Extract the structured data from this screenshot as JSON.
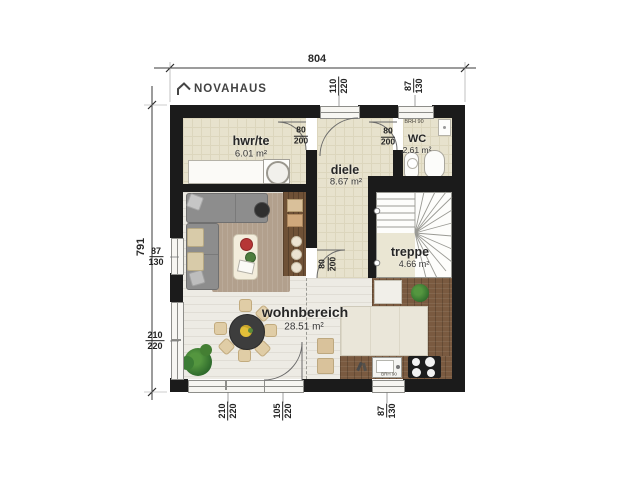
{
  "brand": {
    "name": "NOVAHAUS"
  },
  "dimensions": {
    "total_width": "804",
    "total_height": "791"
  },
  "rooms": {
    "hwrte": {
      "name": "hwr/te",
      "area": "6.01 m²"
    },
    "diele": {
      "name": "diele",
      "area": "8.67 m²"
    },
    "wc": {
      "name": "WC",
      "area": "2.61 m²"
    },
    "treppe": {
      "name": "treppe",
      "area": "4.66 m²"
    },
    "wohnbereich": {
      "name": "wohnbereich",
      "area": "28.51 m²"
    }
  },
  "openings": {
    "entry_door": {
      "w": "110",
      "h": "220"
    },
    "wc_window": {
      "w": "87",
      "h": "130"
    },
    "hwrte_door": {
      "w": "80",
      "h": "200"
    },
    "wc_door": {
      "w": "80",
      "h": "200"
    },
    "wohnbereich_door": {
      "w": "80",
      "h": "200"
    },
    "left_window_upper": {
      "w": "87",
      "h": "130"
    },
    "left_window_lower": {
      "w": "210",
      "h": "220"
    },
    "bottom_window": {
      "w": "210",
      "h": "220"
    },
    "terrace_door": {
      "w": "105",
      "h": "220"
    },
    "kitchen_window": {
      "w": "87",
      "h": "130"
    }
  },
  "annotations": {
    "wc_parapet": "BRH 90",
    "kitchen_parapet": "BRH 90"
  },
  "colors": {
    "wall": "#1b1b1b",
    "tile_floor": "#e7e2cd",
    "wood_floor": "#edebe4",
    "kitchen_wood": "#7a5a40",
    "rug": "#b2a08d",
    "sofa": "#8d8d8d",
    "plant": "#3c7d35",
    "chair": "#e0cda6"
  }
}
